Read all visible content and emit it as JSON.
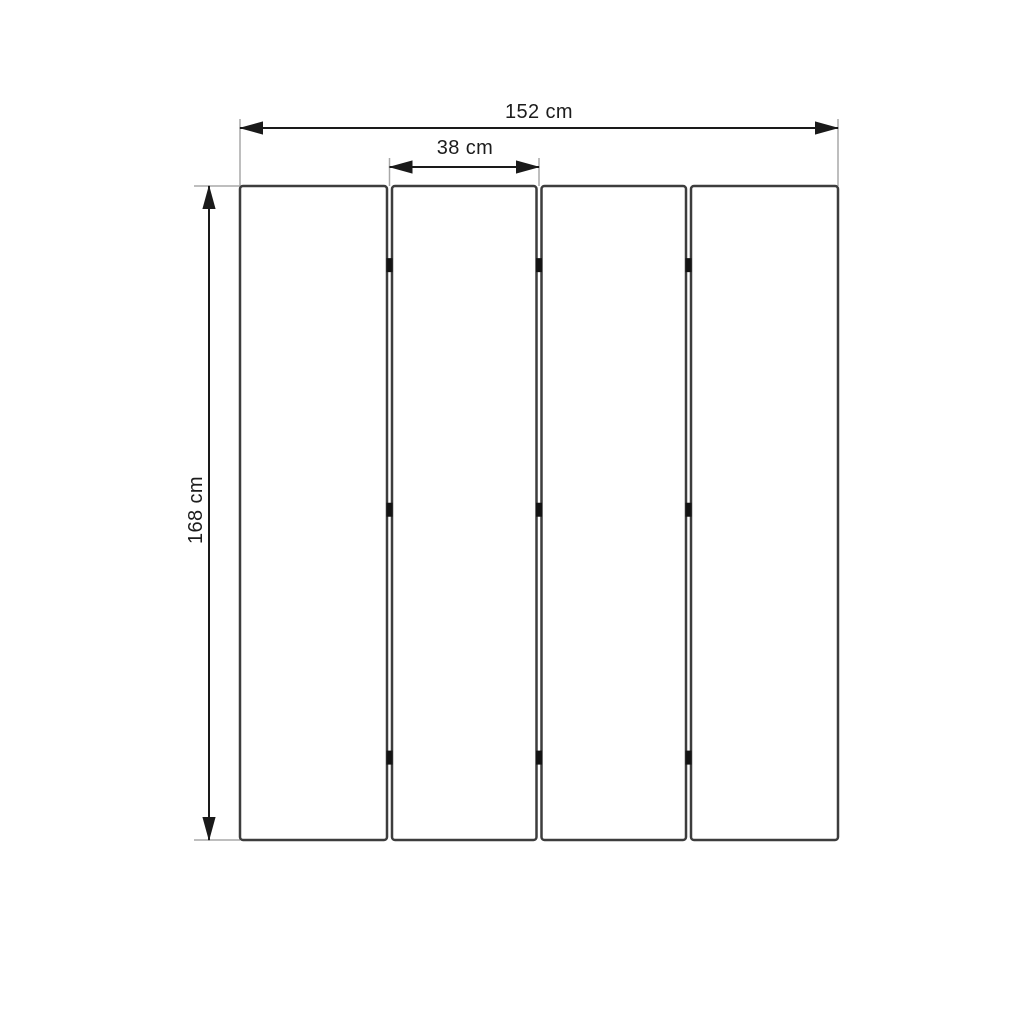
{
  "page": {
    "background_color": "#ffffff"
  },
  "diagram": {
    "description": "Dimension drawing of a four-panel folding screen (room divider), front view",
    "labels": {
      "total_width": "152 cm",
      "panel_width": "38 cm",
      "height": "168 cm"
    },
    "values_cm": {
      "total_width": 152,
      "panel_width": 38,
      "height": 168
    },
    "panel_count": 4,
    "hinge_marks_per_gap": 3,
    "hinge_position_fractions": [
      0.121,
      0.495,
      0.874
    ],
    "colors": {
      "background": "#ffffff",
      "panel_fill": "#ffffff",
      "panel_stroke": "#3d3d3d",
      "dimension_line": "#1a1a1a",
      "extension_line": "#a8a8a8",
      "hinge": "#141414",
      "label_text": "#1c1c1c"
    }
  }
}
